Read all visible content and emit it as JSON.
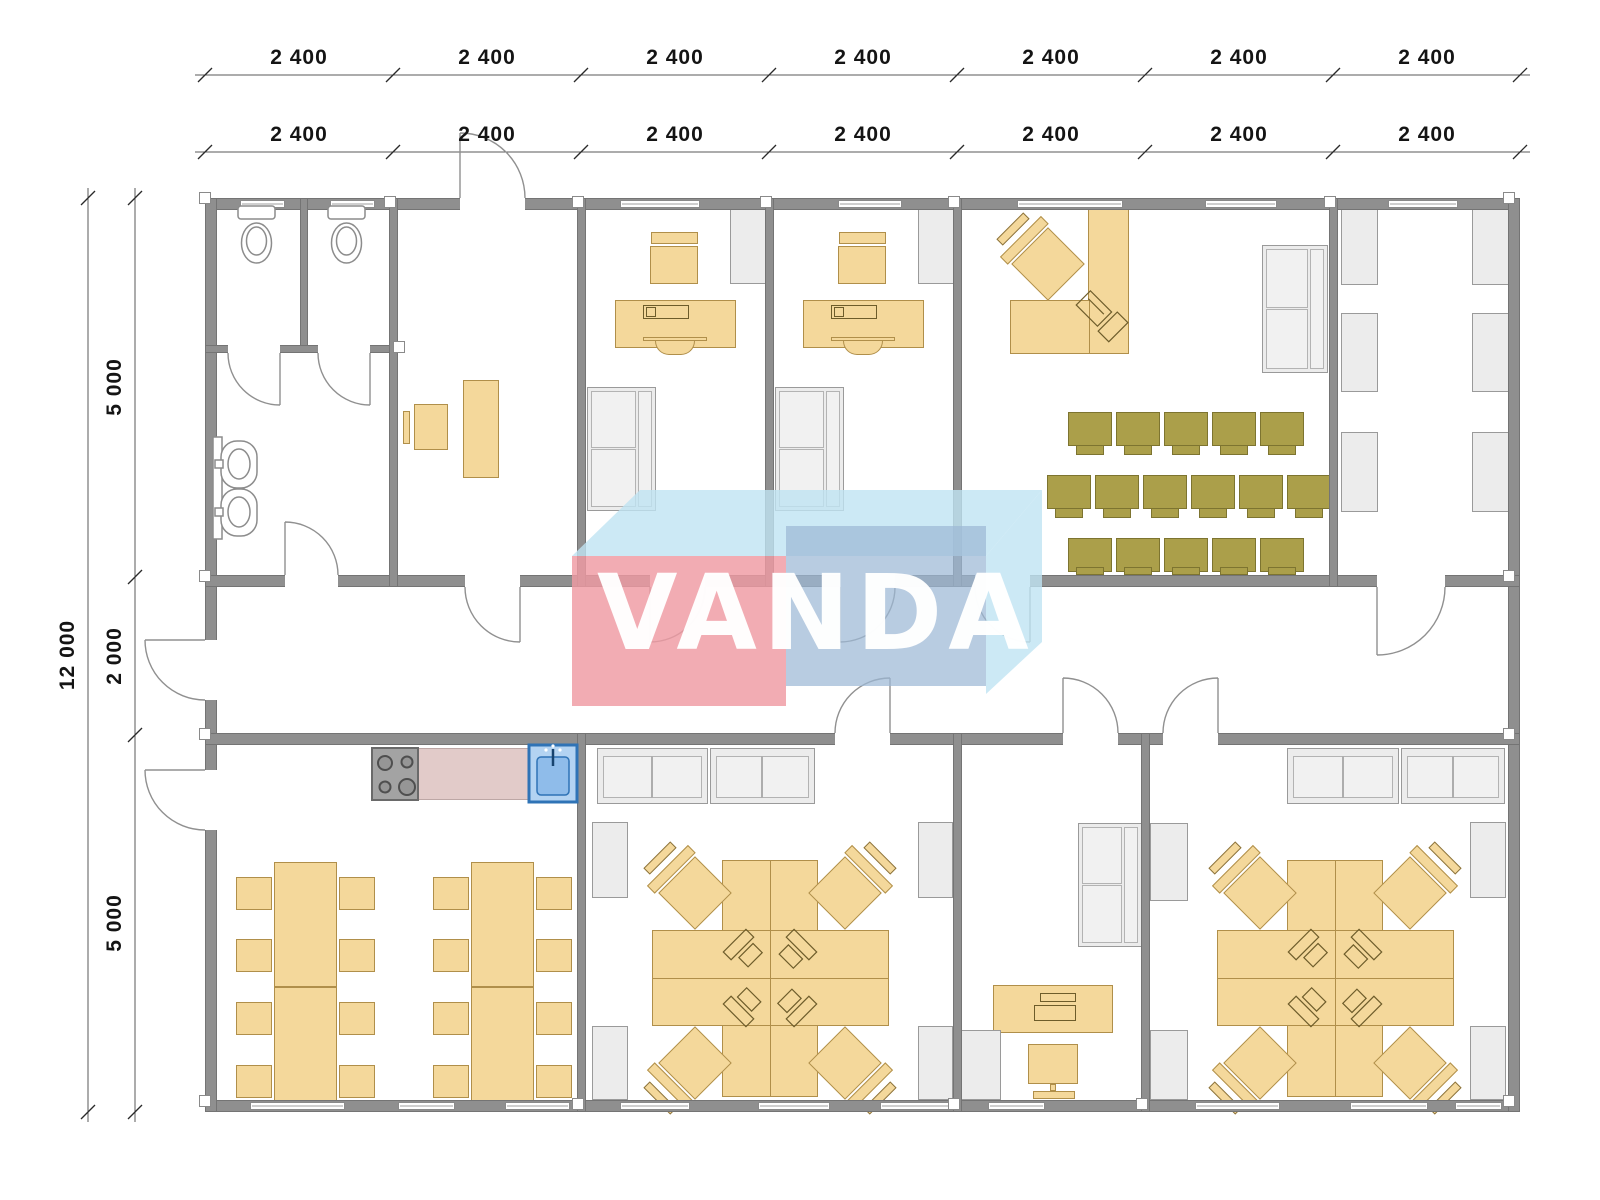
{
  "watermark": {
    "text": "VANDA"
  },
  "dimensions": {
    "top_outer": [
      "2 400",
      "2 400",
      "2 400",
      "2 400",
      "2 400",
      "2 400",
      "2 400"
    ],
    "top_inner": [
      "2 400",
      "2 400",
      "2 400",
      "2 400",
      "2 400",
      "2 400",
      "2 400"
    ],
    "left_total": "12 000",
    "left_inner": [
      "5 000",
      "2 000",
      "5 000"
    ]
  },
  "colors": {
    "wall": "#8f8f8f",
    "furniture_wood": "#f4d89b",
    "furniture_wood_border": "#b08f4a",
    "chair_olive": "#ab9f4a",
    "chair_olive_border": "#7d7430",
    "furniture_gray": "#ececec",
    "counter_pink": "#e2cbc9",
    "sink_blue_fill": "#b3d3f2",
    "sink_blue_border": "#2f73b6",
    "stove_gray": "#a3a3a3",
    "watermark_red": "#ef9aa2",
    "watermark_blue": "#9db8d6",
    "watermark_lightblue": "#bfe3f2",
    "dimension_text": "#141414"
  }
}
